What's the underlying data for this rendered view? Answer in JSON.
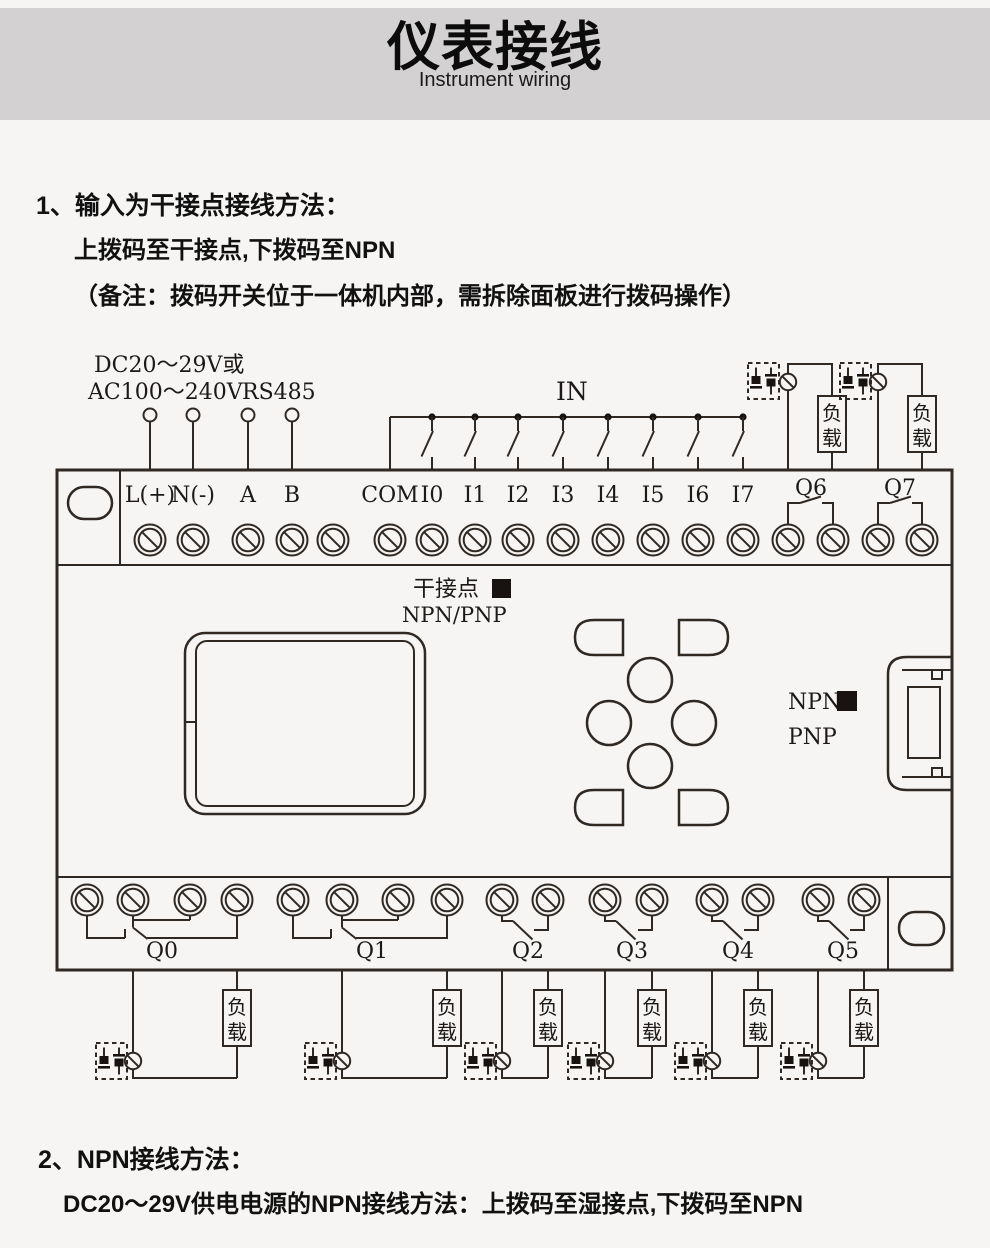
{
  "header": {
    "title": "仪表接线",
    "subtitle": "Instrument wiring"
  },
  "section1": {
    "line1": "1、输入为干接点接线方法：",
    "line2": "上拨码至干接点,下拨码至NPN",
    "line3": "（备注：拨码开关位于一体机内部，需拆除面板进行拨码操作）"
  },
  "section2": {
    "line1": "2、NPN接线方法：",
    "line2": "DC20～29V供电电源的NPN接线方法：上拨码至湿接点,下拨码至NPN"
  },
  "diagram": {
    "power_line1": "DC20～29V或",
    "power_line2": "AC100～240V",
    "rs485": "RS485",
    "in_label": "IN",
    "top_terminals": [
      "L(+)",
      "N(-)",
      "A",
      "B",
      "COM",
      "I0",
      "I1",
      "I2",
      "I3",
      "I4",
      "I5",
      "I6",
      "I7"
    ],
    "relay_q6": "Q6",
    "relay_q7": "Q7",
    "dry_contact": "干接点",
    "npn_pnp": "NPN/PNP",
    "npn": "NPN",
    "pnp": "PNP",
    "load_char1": "负",
    "load_char2": "载",
    "outputs_bottom": [
      "Q0",
      "Q1",
      "Q2",
      "Q3",
      "Q4",
      "Q5"
    ]
  },
  "colors": {
    "line": "#2f2823",
    "header_bg": "#d3d1d1",
    "page_bg": "#f6f5f3",
    "indicator_square": "#181310"
  }
}
